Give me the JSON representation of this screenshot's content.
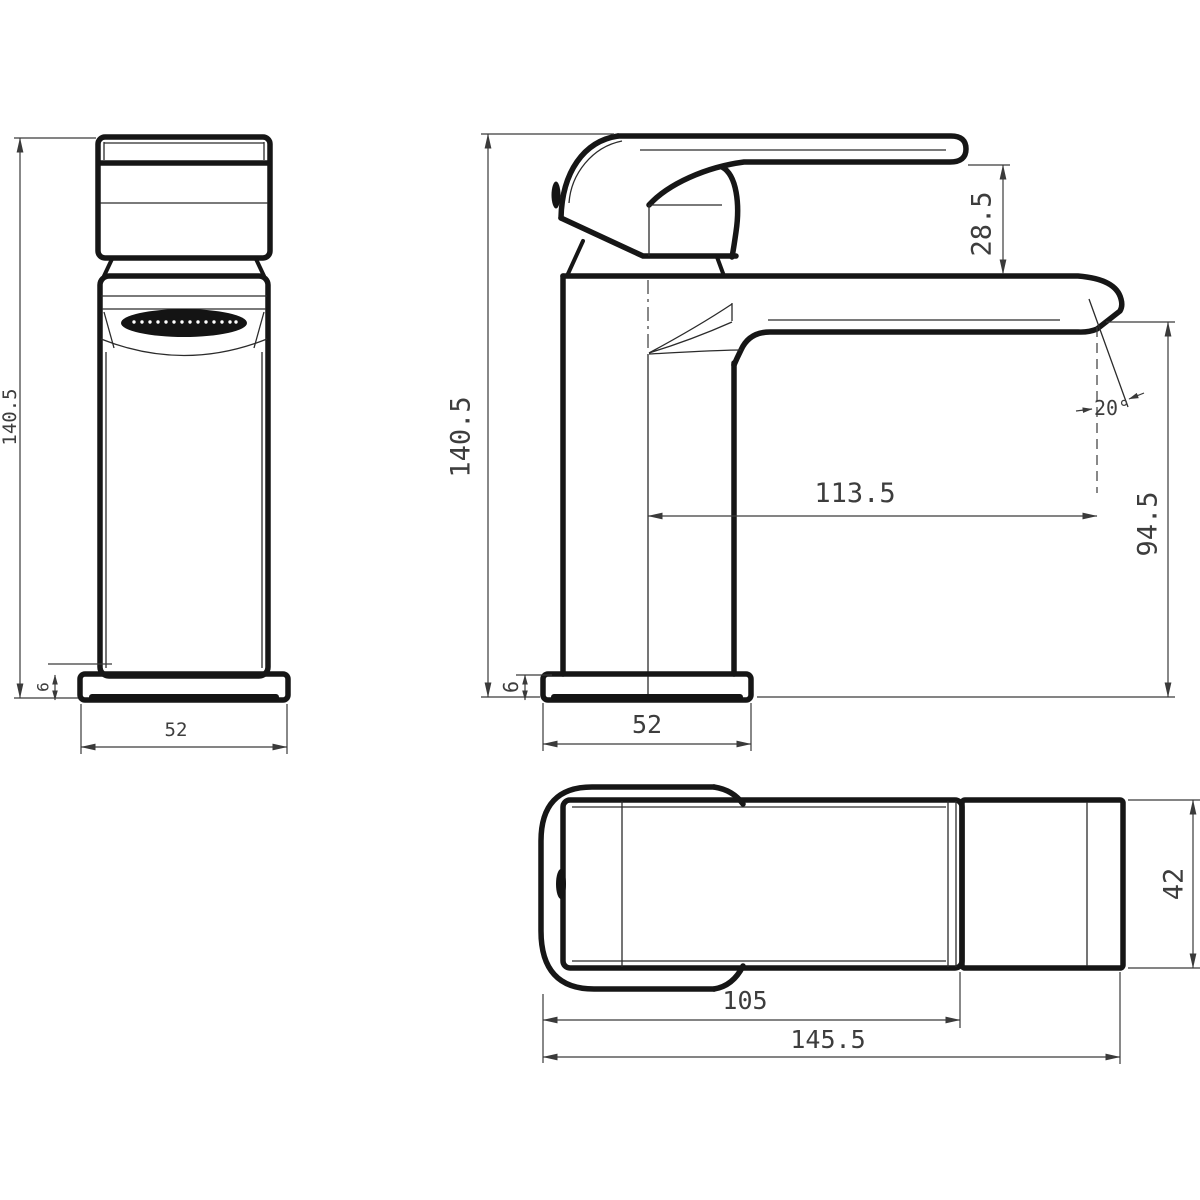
{
  "drawing": {
    "type": "technical-dimension-drawing",
    "subject": "basin mixer tap, three orthographic views",
    "background": "#ffffff",
    "line_color": "#161616",
    "text_color": "#3d3d3d",
    "views": {
      "front": {
        "label": "front view"
      },
      "side": {
        "label": "side view"
      },
      "plan": {
        "label": "plan view"
      }
    },
    "dimensions": {
      "front_height": "140.5",
      "front_base_height": "6",
      "front_base_width": "52",
      "side_height": "140.5",
      "handle_to_spout": "28.5",
      "spout_angle": "20°",
      "spout_reach": "113.5",
      "outlet_height": "94.5",
      "side_base_height": "6",
      "side_base_width": "52",
      "plan_body_length": "105",
      "plan_total_length": "145.5",
      "plan_width": "42"
    }
  }
}
